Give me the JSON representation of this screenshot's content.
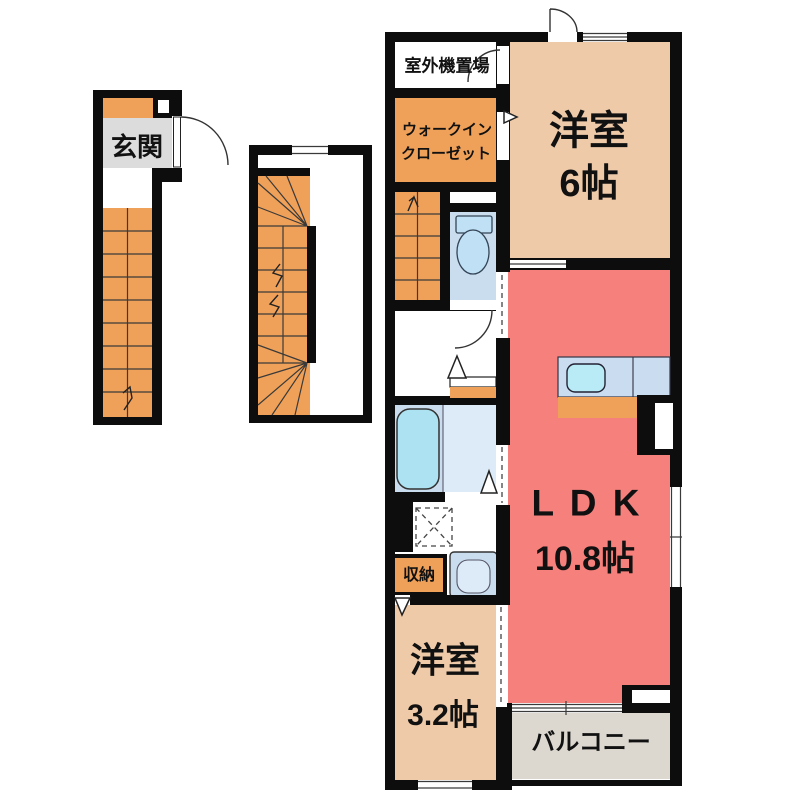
{
  "plan": {
    "floor1": {
      "entrance": "玄関"
    },
    "floor2": {
      "outdoor_unit": "室外機置場",
      "walk_in_closet": [
        "ウォークイン",
        "クローゼット"
      ],
      "western_room_6": {
        "name": "洋室",
        "size": "6帖"
      },
      "ldk": {
        "name": "L D K",
        "size": "10.8帖"
      },
      "storage": "収納",
      "western_room_3": {
        "name": "洋室",
        "size": "3.2帖"
      },
      "balcony": "バルコニー"
    }
  },
  "colors": {
    "wall": "#0d0d0d",
    "orange": "#F0A159",
    "tan": "#EFCAA9",
    "red": "#F5807C",
    "blue": "#C9DDEE",
    "tub": "#ACE2F2",
    "sink": "#B9EBF6",
    "counter": "#C9DCF0",
    "wash_light": "#DCEBF7",
    "gray_genkan": "#DCDCDC",
    "gray_balcony": "#DCD8D0"
  }
}
